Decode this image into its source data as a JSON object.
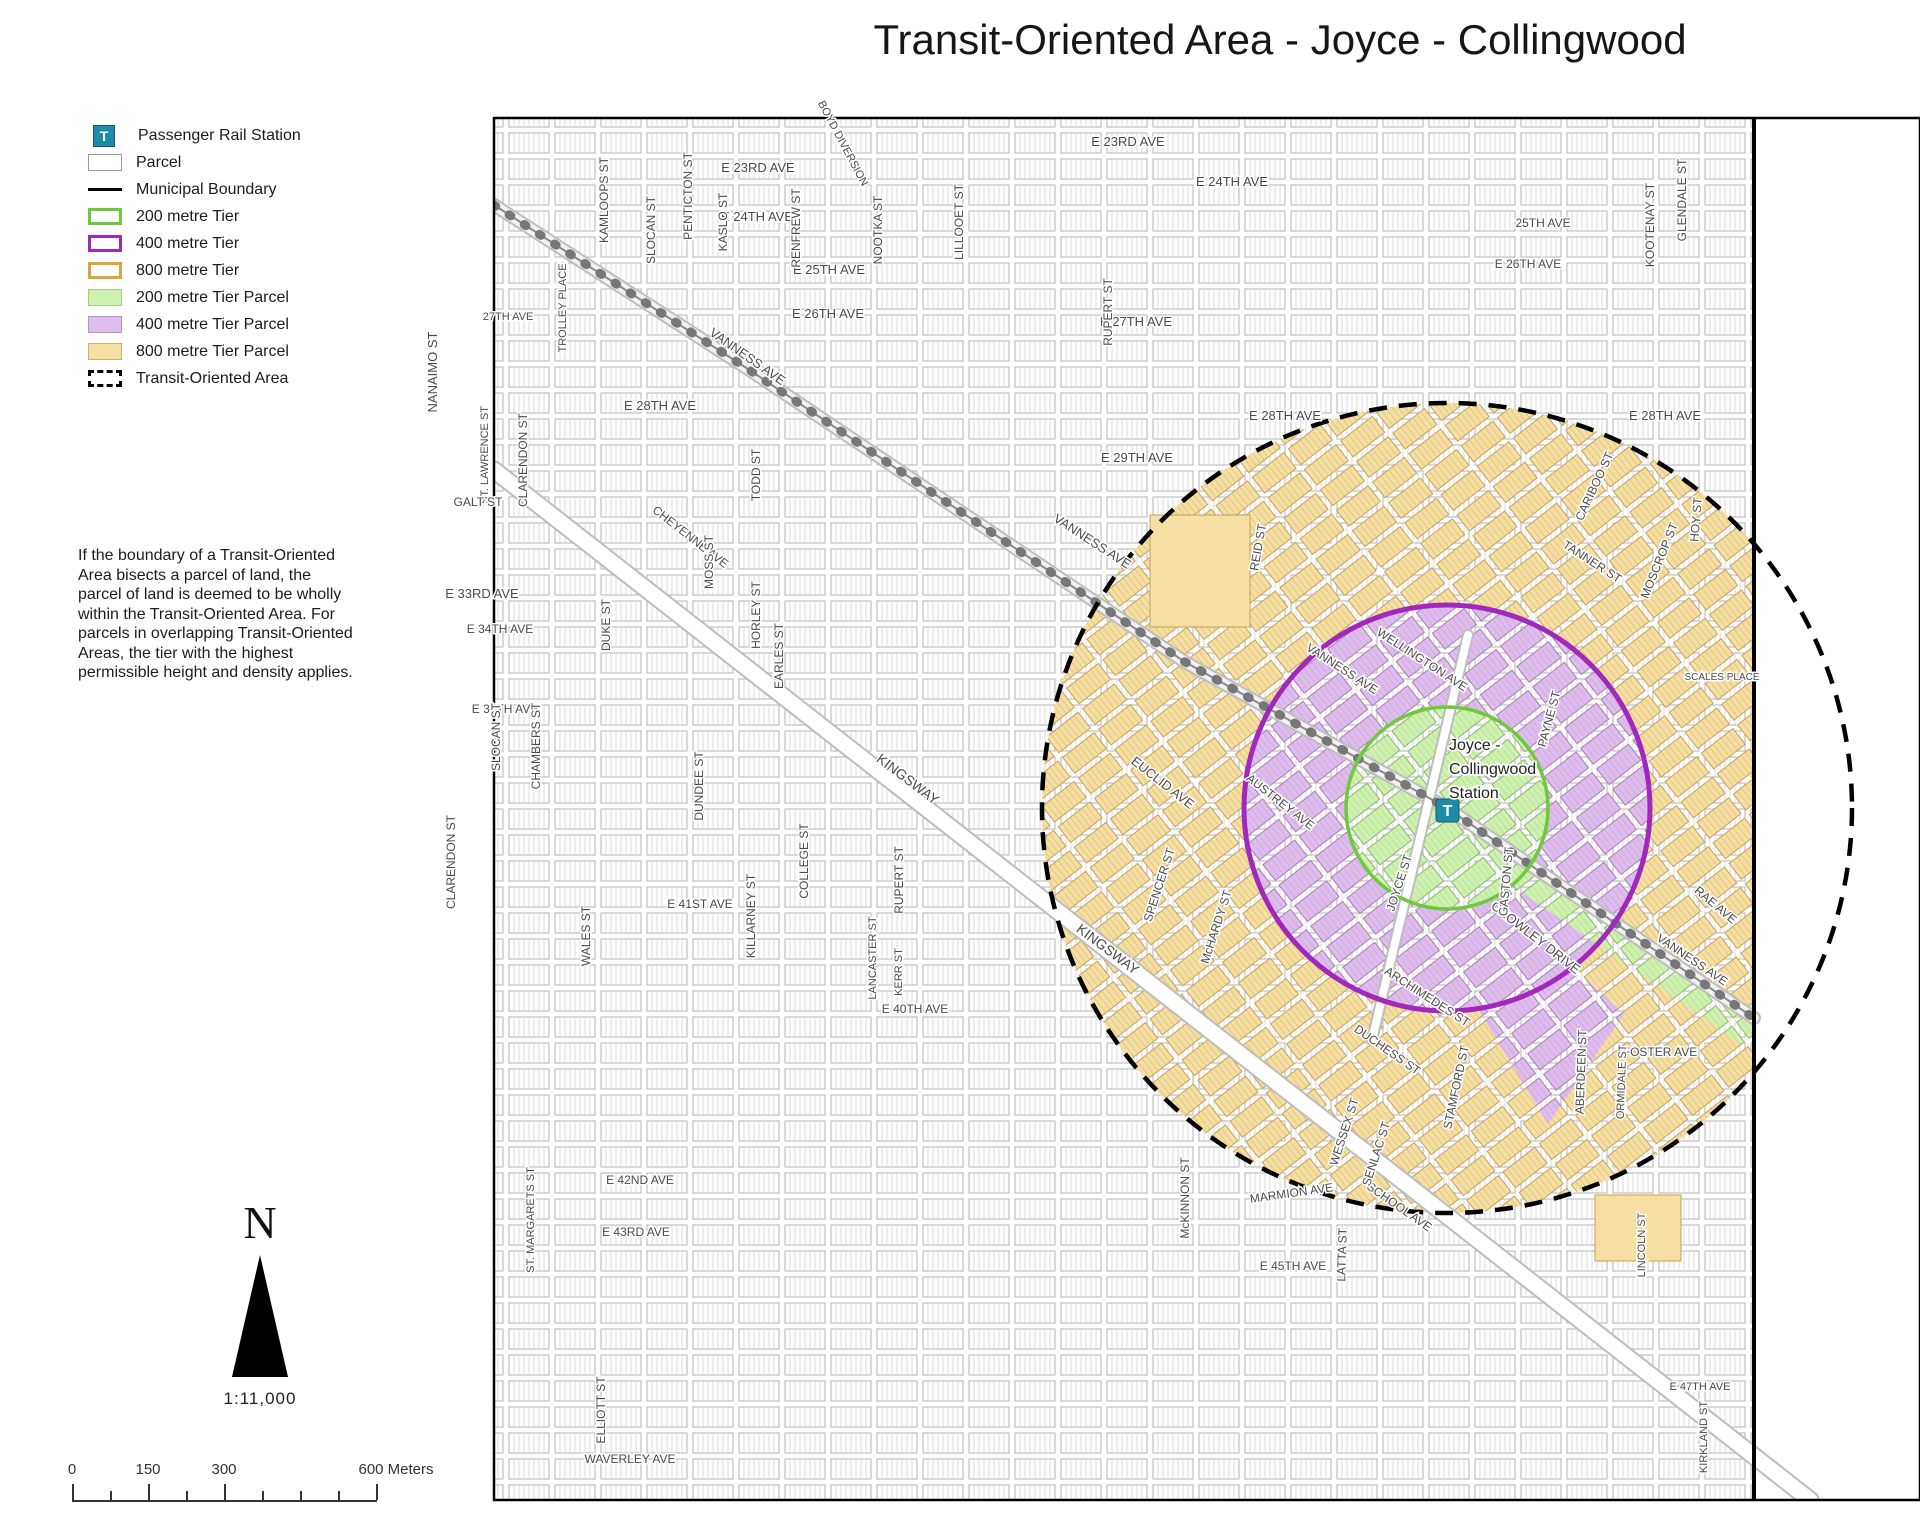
{
  "title": "Transit-Oriented Area - Joyce - Collingwood",
  "legend": {
    "items": [
      {
        "label": "Passenger Rail Station",
        "swatch": "station",
        "icon_text": "T"
      },
      {
        "label": "Parcel",
        "swatch": "parcel"
      },
      {
        "label": "Municipal Boundary",
        "swatch": "boundary"
      },
      {
        "label": "200 metre Tier",
        "swatch": "ring-green"
      },
      {
        "label": "400 metre Tier",
        "swatch": "ring-purple"
      },
      {
        "label": "800 metre Tier",
        "swatch": "ring-gold"
      },
      {
        "label": "200 metre Tier Parcel",
        "swatch": "fill-green"
      },
      {
        "label": "400 metre Tier Parcel",
        "swatch": "fill-purple"
      },
      {
        "label": "800 metre Tier Parcel",
        "swatch": "fill-tan"
      },
      {
        "label": "Transit-Oriented Area",
        "swatch": "toa"
      }
    ]
  },
  "note": "If the boundary of a Transit-Oriented Area bisects a parcel of land, the parcel of land is deemed to be wholly within the Transit-Oriented Area. For parcels in overlapping Transit-Oriented Areas, the tier with the highest permissible height and density applies.",
  "north": {
    "letter": "N",
    "scale_ratio": "1:11,000"
  },
  "scale_bar": {
    "labels": [
      {
        "text": "0",
        "x": 72
      },
      {
        "text": "150",
        "x": 148
      },
      {
        "text": "300",
        "x": 224
      },
      {
        "text": "600 Meters",
        "x": 396
      }
    ],
    "ticks": [
      {
        "x": 72,
        "long": true
      },
      {
        "x": 110,
        "long": false
      },
      {
        "x": 148,
        "long": true
      },
      {
        "x": 186,
        "long": false
      },
      {
        "x": 224,
        "long": true
      },
      {
        "x": 262,
        "long": false
      },
      {
        "x": 300,
        "long": false
      },
      {
        "x": 338,
        "long": false
      },
      {
        "x": 376,
        "long": true
      }
    ]
  },
  "map": {
    "station": {
      "icon_text": "T",
      "lines": [
        "Joyce -",
        "Collingwood",
        "Station"
      ]
    },
    "rings": [
      {
        "name": "200 metre Tier",
        "radius_m": 200,
        "color": "#6FC93D"
      },
      {
        "name": "400 metre Tier",
        "radius_m": 400,
        "color": "#A227BC"
      },
      {
        "name": "Transit-Oriented Area (800 m)",
        "radius_m": 800,
        "color": "#000000",
        "style": "dashed"
      }
    ],
    "labels": [
      {
        "t": "E 23RD AVE",
        "x": 758,
        "y": 172,
        "r": 0,
        "s": 13
      },
      {
        "t": "E 23RD AVE",
        "x": 1128,
        "y": 146,
        "r": 0,
        "s": 13
      },
      {
        "t": "E 24TH AVE",
        "x": 1232,
        "y": 186,
        "r": 0,
        "s": 13
      },
      {
        "t": "E 24TH AVE",
        "x": 757,
        "y": 221,
        "r": 0,
        "s": 13
      },
      {
        "t": "25TH AVE",
        "x": 1543,
        "y": 227,
        "r": 0,
        "s": 12
      },
      {
        "t": "E 25TH AVE",
        "x": 829,
        "y": 274,
        "r": 0,
        "s": 13
      },
      {
        "t": "E 26TH AVE",
        "x": 828,
        "y": 318,
        "r": 0,
        "s": 13
      },
      {
        "t": "E 26TH AVE",
        "x": 1528,
        "y": 268,
        "r": 0,
        "s": 12
      },
      {
        "t": "27TH AVE",
        "x": 508,
        "y": 320,
        "r": 0,
        "s": 11
      },
      {
        "t": "E 27TH AVE",
        "x": 1136,
        "y": 326,
        "r": 0,
        "s": 13
      },
      {
        "t": "E 28TH AVE",
        "x": 660,
        "y": 410,
        "r": 0,
        "s": 13
      },
      {
        "t": "E 28TH AVE",
        "x": 1285,
        "y": 420,
        "r": 0,
        "s": 13
      },
      {
        "t": "E 28TH AVE",
        "x": 1665,
        "y": 420,
        "r": 0,
        "s": 13
      },
      {
        "t": "E 29TH AVE",
        "x": 1137,
        "y": 462,
        "r": 0,
        "s": 13
      },
      {
        "t": "KAMLOOPS ST",
        "x": 608,
        "y": 200,
        "r": -90,
        "s": 12
      },
      {
        "t": "PENTICTON ST",
        "x": 692,
        "y": 196,
        "r": -90,
        "s": 12
      },
      {
        "t": "SLOCAN ST",
        "x": 655,
        "y": 230,
        "r": -90,
        "s": 12
      },
      {
        "t": "KASLO ST",
        "x": 727,
        "y": 222,
        "r": -90,
        "s": 12
      },
      {
        "t": "RENFREW ST",
        "x": 800,
        "y": 228,
        "r": -90,
        "s": 12
      },
      {
        "t": "NOOTKA ST",
        "x": 882,
        "y": 230,
        "r": -90,
        "s": 12
      },
      {
        "t": "LILLOOET ST",
        "x": 963,
        "y": 222,
        "r": -90,
        "s": 12
      },
      {
        "t": "RUPERT ST",
        "x": 1112,
        "y": 312,
        "r": -90,
        "s": 12
      },
      {
        "t": "KOOTENAY ST",
        "x": 1654,
        "y": 225,
        "r": -90,
        "s": 12
      },
      {
        "t": "GLENDALE ST",
        "x": 1686,
        "y": 200,
        "r": -90,
        "s": 12
      },
      {
        "t": "BOYD DIVERSION",
        "x": 840,
        "y": 145,
        "r": 62,
        "s": 11
      },
      {
        "t": "NANAIMO ST",
        "x": 437,
        "y": 372,
        "r": -90,
        "s": 13
      },
      {
        "t": "TROLLEY PLACE",
        "x": 566,
        "y": 308,
        "r": -90,
        "s": 11
      },
      {
        "t": "VANNESS AVE",
        "x": 745,
        "y": 360,
        "r": 35,
        "s": 13
      },
      {
        "t": "VANNESS AVE",
        "x": 1090,
        "y": 545,
        "r": 33,
        "s": 13
      },
      {
        "t": "VANNESS AVE",
        "x": 1340,
        "y": 672,
        "r": 33,
        "s": 12
      },
      {
        "t": "VANNESS AVE",
        "x": 1690,
        "y": 963,
        "r": 34,
        "s": 12
      },
      {
        "t": "ST. LAWRENCE ST",
        "x": 488,
        "y": 455,
        "r": -90,
        "s": 11
      },
      {
        "t": "CLARENDON ST",
        "x": 527,
        "y": 460,
        "r": -90,
        "s": 12
      },
      {
        "t": "CLARENDON ST",
        "x": 455,
        "y": 862,
        "r": -90,
        "s": 12
      },
      {
        "t": "GALT ST",
        "x": 478,
        "y": 506,
        "r": 0,
        "s": 12
      },
      {
        "t": "CHEYENNE AVE",
        "x": 688,
        "y": 540,
        "r": 38,
        "s": 12
      },
      {
        "t": "TODD ST",
        "x": 760,
        "y": 475,
        "r": -90,
        "s": 12
      },
      {
        "t": "E 33RD AVE",
        "x": 482,
        "y": 598,
        "r": 0,
        "s": 13
      },
      {
        "t": "E 34TH AVE",
        "x": 500,
        "y": 633,
        "r": 0,
        "s": 12
      },
      {
        "t": "MOSS ST",
        "x": 713,
        "y": 562,
        "r": -90,
        "s": 12
      },
      {
        "t": "DUKE ST",
        "x": 610,
        "y": 625,
        "r": -90,
        "s": 12
      },
      {
        "t": "HORLEY ST",
        "x": 760,
        "y": 615,
        "r": -90,
        "s": 12
      },
      {
        "t": "EARLES ST",
        "x": 783,
        "y": 656,
        "r": -90,
        "s": 12
      },
      {
        "t": "EUCLID AVE",
        "x": 1160,
        "y": 786,
        "r": 38,
        "s": 13
      },
      {
        "t": "REID ST",
        "x": 1262,
        "y": 548,
        "r": -80,
        "s": 12
      },
      {
        "t": "KINGSWAY",
        "x": 905,
        "y": 783,
        "r": 37,
        "s": 14
      },
      {
        "t": "KINGSWAY",
        "x": 1105,
        "y": 953,
        "r": 37,
        "s": 14
      },
      {
        "t": "E 37TH AVE",
        "x": 505,
        "y": 713,
        "r": 0,
        "s": 12
      },
      {
        "t": "SLOCAN ST",
        "x": 500,
        "y": 737,
        "r": -90,
        "s": 12
      },
      {
        "t": "CHAMBERS ST",
        "x": 540,
        "y": 746,
        "r": -90,
        "s": 12
      },
      {
        "t": "DUNDEE ST",
        "x": 703,
        "y": 786,
        "r": -90,
        "s": 12
      },
      {
        "t": "COLLEGE ST",
        "x": 808,
        "y": 861,
        "r": -90,
        "s": 12
      },
      {
        "t": "RUPERT ST",
        "x": 903,
        "y": 880,
        "r": -90,
        "s": 12
      },
      {
        "t": "WALES ST",
        "x": 590,
        "y": 936,
        "r": -90,
        "s": 12
      },
      {
        "t": "E 41ST AVE",
        "x": 700,
        "y": 908,
        "r": 0,
        "s": 12
      },
      {
        "t": "KILLARNEY ST",
        "x": 755,
        "y": 916,
        "r": -90,
        "s": 12
      },
      {
        "t": "LANCASTER ST",
        "x": 876,
        "y": 958,
        "r": -90,
        "s": 11
      },
      {
        "t": "KERR ST",
        "x": 902,
        "y": 972,
        "r": -90,
        "s": 11
      },
      {
        "t": "E 40TH AVE",
        "x": 915,
        "y": 1013,
        "r": 0,
        "s": 12
      },
      {
        "t": "McKINNON ST",
        "x": 1189,
        "y": 1198,
        "r": -90,
        "s": 12
      },
      {
        "t": "MARMION AVE",
        "x": 1292,
        "y": 1197,
        "r": -8,
        "s": 12
      },
      {
        "t": "SCHOOL AVE",
        "x": 1397,
        "y": 1210,
        "r": 35,
        "s": 12
      },
      {
        "t": "WESSEX ST",
        "x": 1348,
        "y": 1133,
        "r": -72,
        "s": 12
      },
      {
        "t": "SENLAC ST",
        "x": 1380,
        "y": 1155,
        "r": -72,
        "s": 12
      },
      {
        "t": "LATTA ST",
        "x": 1346,
        "y": 1255,
        "r": -88,
        "s": 12
      },
      {
        "t": "DUCHESS ST",
        "x": 1385,
        "y": 1053,
        "r": 35,
        "s": 12
      },
      {
        "t": "STAMFORD ST",
        "x": 1460,
        "y": 1088,
        "r": -78,
        "s": 12
      },
      {
        "t": "ABERDEEN ST",
        "x": 1585,
        "y": 1072,
        "r": -88,
        "s": 12
      },
      {
        "t": "FOSTER AVE",
        "x": 1660,
        "y": 1056,
        "r": 0,
        "s": 12
      },
      {
        "t": "RAE AVE",
        "x": 1713,
        "y": 908,
        "r": 40,
        "s": 12
      },
      {
        "t": "ORMIDALE ST",
        "x": 1625,
        "y": 1082,
        "r": -88,
        "s": 11
      },
      {
        "t": "CROWLEY DRIVE",
        "x": 1533,
        "y": 941,
        "r": 38,
        "s": 13
      },
      {
        "t": "GASTON ST",
        "x": 1510,
        "y": 882,
        "r": -85,
        "s": 12
      },
      {
        "t": "JOYCE ST",
        "x": 1403,
        "y": 884,
        "r": -72,
        "s": 12
      },
      {
        "t": "ARCHIMEDES ST",
        "x": 1425,
        "y": 1000,
        "r": 33,
        "s": 12
      },
      {
        "t": "AUSTREY AVE",
        "x": 1278,
        "y": 805,
        "r": 38,
        "s": 12
      },
      {
        "t": "SPENCER ST",
        "x": 1163,
        "y": 886,
        "r": -72,
        "s": 12
      },
      {
        "t": "McHARDY ST",
        "x": 1220,
        "y": 928,
        "r": -72,
        "s": 12
      },
      {
        "t": "WELLINGTON AVE",
        "x": 1420,
        "y": 663,
        "r": 33,
        "s": 12
      },
      {
        "t": "PAYNE ST",
        "x": 1553,
        "y": 720,
        "r": -75,
        "s": 12
      },
      {
        "t": "TANNER ST",
        "x": 1590,
        "y": 565,
        "r": 33,
        "s": 12
      },
      {
        "t": "MOSCROP ST",
        "x": 1663,
        "y": 562,
        "r": -68,
        "s": 12
      },
      {
        "t": "HOY ST",
        "x": 1700,
        "y": 520,
        "r": -85,
        "s": 12
      },
      {
        "t": "CARIBOO ST",
        "x": 1598,
        "y": 488,
        "r": -65,
        "s": 12
      },
      {
        "t": "SCALES PLACE",
        "x": 1722,
        "y": 680,
        "r": 0,
        "s": 10
      },
      {
        "t": "E 42ND AVE",
        "x": 640,
        "y": 1184,
        "r": 0,
        "s": 12
      },
      {
        "t": "E 43RD AVE",
        "x": 636,
        "y": 1236,
        "r": 0,
        "s": 12
      },
      {
        "t": "ST. MARGARETS ST",
        "x": 534,
        "y": 1220,
        "r": -90,
        "s": 11
      },
      {
        "t": "ELLIOTT ST",
        "x": 605,
        "y": 1410,
        "r": -90,
        "s": 12
      },
      {
        "t": "WAVERLEY AVE",
        "x": 630,
        "y": 1463,
        "r": 0,
        "s": 12
      },
      {
        "t": "E 45TH AVE",
        "x": 1293,
        "y": 1270,
        "r": 0,
        "s": 12
      },
      {
        "t": "E 47TH AVE",
        "x": 1700,
        "y": 1390,
        "r": 0,
        "s": 11
      },
      {
        "t": "KIRKLAND ST",
        "x": 1707,
        "y": 1437,
        "r": -90,
        "s": 11
      },
      {
        "t": "LINCOLN ST",
        "x": 1645,
        "y": 1245,
        "r": -90,
        "s": 11
      }
    ]
  },
  "colors": {
    "station_teal": "#1E8CA6",
    "ring_green": "#6FC93D",
    "ring_purple": "#A227BC",
    "ring_gold": "#D7A83F",
    "fill_green": "#CFF2B0",
    "fill_purple": "#DEBDED",
    "fill_tan": "#F6DFA3",
    "boundary_black": "#000000"
  }
}
